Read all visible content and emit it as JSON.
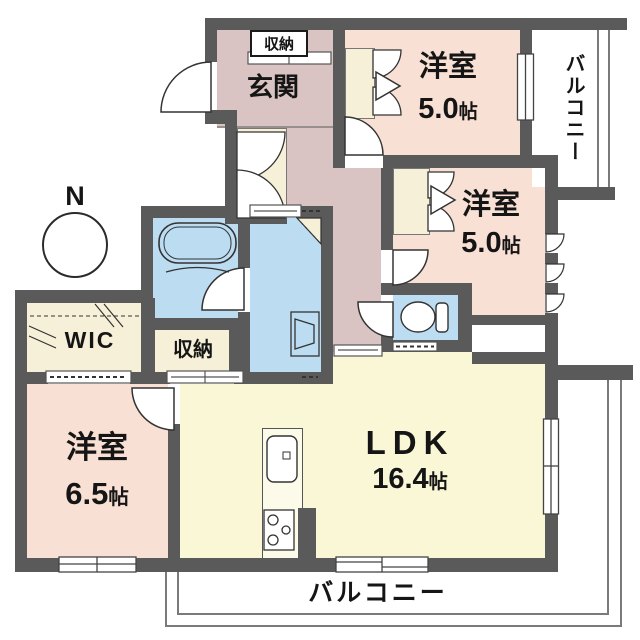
{
  "compass": {
    "north_label": "N"
  },
  "entrance": {
    "label": "玄関",
    "shoe_storage_label": "収納"
  },
  "rooms": {
    "yoshitsu1": {
      "label": "洋室",
      "size": "5.0",
      "unit": "帖"
    },
    "yoshitsu2": {
      "label": "洋室",
      "size": "5.0",
      "unit": "帖"
    },
    "yoshitsu3": {
      "label": "洋室",
      "size": "6.5",
      "unit": "帖"
    },
    "ldk": {
      "label": "LDK",
      "size": "16.4",
      "unit": "帖"
    },
    "wic": {
      "label": "WIC"
    },
    "storage": {
      "label": "収納"
    }
  },
  "balconies": {
    "right": {
      "label": "バルコニー"
    },
    "bottom": {
      "label": "バルコニー"
    }
  },
  "colors": {
    "wall": "#5a5a5a",
    "western_room": "#f9e0d4",
    "hallway": "#d9c4c3",
    "ldk": "#faf7d6",
    "wet_area": "#bcdcf2",
    "closet": "#f6f0d8"
  }
}
